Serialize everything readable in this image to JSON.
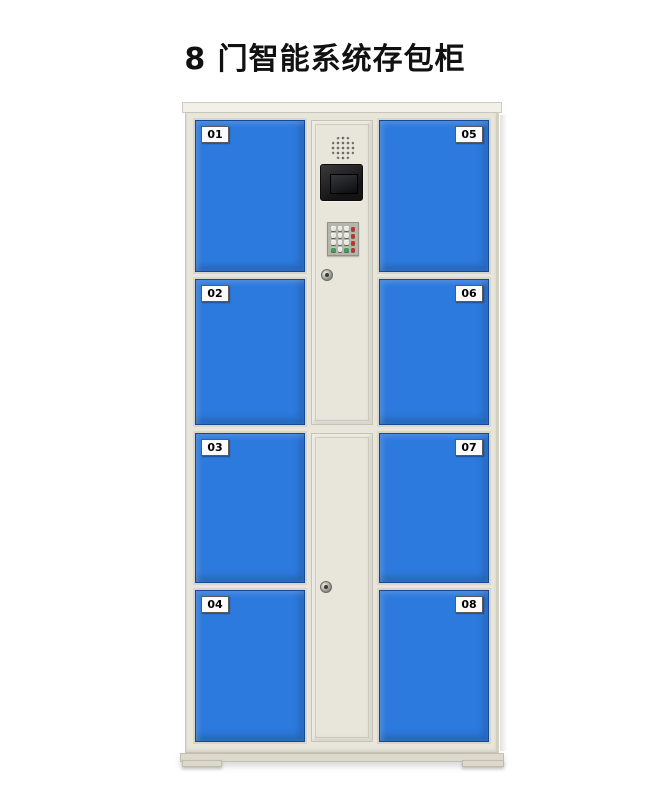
{
  "title": "8 门智能系统存包柜",
  "doors": [
    {
      "number": "01"
    },
    {
      "number": "02"
    },
    {
      "number": "03"
    },
    {
      "number": "04"
    },
    {
      "number": "05"
    },
    {
      "number": "06"
    },
    {
      "number": "07"
    },
    {
      "number": "08"
    }
  ],
  "control_panel": {
    "speaker_icon": "speaker-grill-icon",
    "display": "lcd-display-screen",
    "keypad_rows": [
      [
        "white",
        "white",
        "white",
        "red"
      ],
      [
        "white",
        "white",
        "white",
        "red"
      ],
      [
        "white",
        "white",
        "white",
        "red"
      ],
      [
        "green",
        "white",
        "green",
        "red"
      ]
    ],
    "locks": [
      "upper-keyhole",
      "lower-keyhole"
    ]
  },
  "colors": {
    "door_blue": "#2d7ade",
    "frame_beige": "#e8e6db",
    "title_black": "#111111",
    "key_white": "#e8e8e2",
    "key_red": "#b5372c",
    "key_green": "#3f9e5a"
  }
}
